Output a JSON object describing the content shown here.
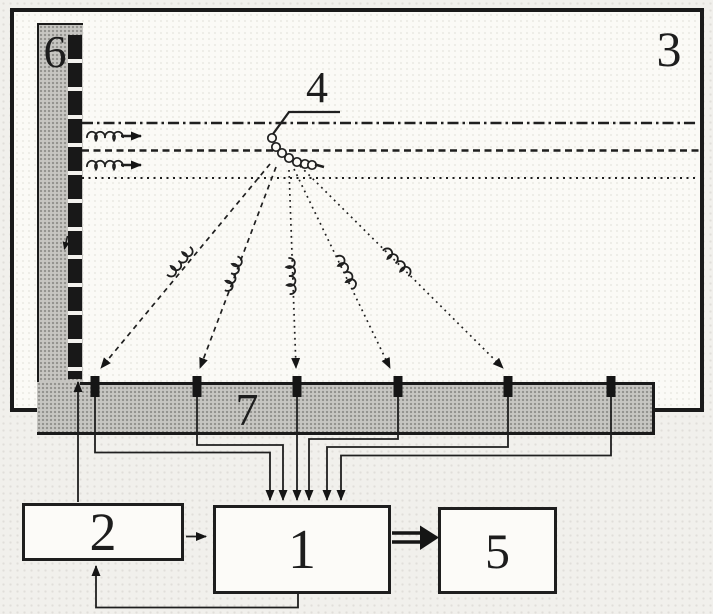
{
  "components": {
    "box_1": {
      "label": "1"
    },
    "box_2": {
      "label": "2"
    },
    "chamber_3": {
      "label": "3"
    },
    "sample_4": {
      "label": "4"
    },
    "box_5": {
      "label": "5"
    },
    "source_bar_6": {
      "label": "6"
    },
    "detector_bar_7": {
      "label": "7"
    }
  },
  "detectors": {
    "count": 6
  },
  "colors": {
    "ink": "#1a1a1a",
    "bar_fill": "#c7c6c2",
    "chamber_fill": "#fbfaf6",
    "page_background": "#f1f0ec",
    "box_fill": "#fcfbf8"
  }
}
